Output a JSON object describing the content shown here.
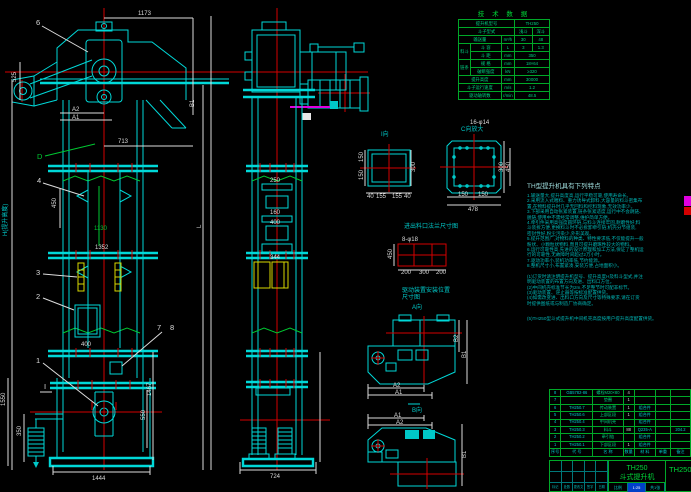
{
  "callouts": {
    "n1": "1",
    "n2": "2",
    "n3": "3",
    "n4": "4",
    "n6": "6",
    "n7": "7",
    "n8": "8"
  },
  "labels": {
    "h_axis": "H(提升高度)",
    "l_axis": "L",
    "d": "D",
    "sec": "I",
    "view_i": "I向",
    "view_c": "C向放大",
    "view_a": "A向",
    "view_b": "B向",
    "caption_flange": "进出料口法兰尺寸图",
    "drive1": "驱动装置安装位置",
    "drive2": "尺寸图"
  },
  "dims": {
    "head_width": "1173",
    "head_offset": "713",
    "head_height": "525",
    "a2": "A2",
    "a1": "A1",
    "head_b1": "B1",
    "section_green": "1130",
    "bucket_pitch": "450",
    "mid_width": "1352",
    "door_width": "400",
    "boot_h1": "1467",
    "boot_h2": "550",
    "boot_left": "1550",
    "spring_h": "350",
    "base_width": "1444",
    "front_width": "724",
    "f1": "250",
    "f2": "160",
    "f3": "400",
    "f4": "344",
    "fa_right": "300",
    "fa_left1": "150",
    "fa_left2": "150",
    "fa_b1": "40",
    "fa_b2": "155",
    "fa_b3": "155",
    "fa_b4": "40",
    "fb_note": "16-φ14",
    "fb_right1": "300",
    "fb_right2": "450",
    "fb_b1": "150",
    "fb_b2": "150",
    "fb_width": "478",
    "bolt_note": "8-φ18",
    "bolt_left": "450",
    "bolt_b1": "200",
    "bolt_b2": "300",
    "bolt_b3": "200",
    "va_a2": "A2",
    "va_a1": "A1",
    "va_b1": "B1",
    "va_b2": "B2",
    "vb_a1": "A1",
    "vb_a2": "A2",
    "vb_b1": "B1"
  },
  "tech": {
    "title": "技 术 数 据",
    "r1": {
      "label": "提升机型号",
      "value": "TH250"
    },
    "r2": {
      "label": "斗子型式",
      "v1": "浅斗",
      "v2": "深斗"
    },
    "r3": {
      "label": "输送量",
      "unit": "m³/h",
      "v1": "30",
      "v2": "48"
    },
    "r4": {
      "group": "料斗",
      "label": "斗 容",
      "unit": "L",
      "v1": "3",
      "v2": "1.3"
    },
    "r5": {
      "label": "斗 距",
      "unit": "mm",
      "value": "350"
    },
    "r6": {
      "group": "链条",
      "label": "规 格",
      "unit": "mm",
      "value": "18×64"
    },
    "r7": {
      "label": "破断强度",
      "unit": "kN",
      "value": "≥320"
    },
    "r8": {
      "label": "提升高度",
      "unit": "mm",
      "value": "30000"
    },
    "r9": {
      "label": "斗子运行速度",
      "unit": "m/s",
      "value": "1.2"
    },
    "r10": {
      "label": "驱动轴转数",
      "unit": "r/min",
      "value": "48.5"
    }
  },
  "features": {
    "heading": "TH型提升机具有下列特点",
    "lines": [
      "1.输送量大,提升高度高,运行平稳可靠,使用寿命长。",
      "2.采用流入式喂料、重力诱导式卸料,大容量的料斗密集布",
      "  置,在物料提升时几乎无回料和挖料现象,无效功率少。",
      "3.下部采用自动张紧装置,链条张紧适度,运行中不会跳链、",
      "  脱链,使用中不需经常调整,维护简单方便。",
      "4.牵引件采用高强度圆环链,与料斗连接牢固,耐磨性好;料",
      "  斗装拆方便,更换料斗时不必拆卸牵引链;机壳分节组装,",
      "  密封性好,粉尘污染少,外形美观。",
      "5.提升范围广,对物料的种类、特性要求低,不仅能提升一般",
      "  粉状、小颗粒状物料,而且可提升磨琢性较大的物料。",
      "6.运行可靠性高,先进的设计原理和加工方法,保证了整机运",
      "  行的可靠性,无故障时间超过2万小时。",
      "7.驱动功率小,装机功率低,节约能源。",
      "8.整机尺寸小,布置紧凑,安装方便,占地面积小。"
    ],
    "notes": [
      "(1)订货时请注明提升机型号、提升高度H及料斗型式,并注",
      "   明驱动装置的布置方向及进、出料口方位。",
      "(2)中间机壳标准节长为2m,不足整节时可配非标节。",
      "(3)驱动装置、逆止器等按标准配置供货。",
      "(4)如需改变进、出料口方向及尺寸等特殊要求,请在订货",
      "   时提供图纸或与制造厂协商确定。"
    ],
    "final": "(5)TH250型斗式提升机中间机壳高度按用户提升高度配置供货。"
  },
  "bom": {
    "headers": [
      "序号",
      "代 号",
      "名 称",
      "数量",
      "材 料",
      "单重",
      "备注"
    ],
    "rows": [
      [
        "8",
        "GB5782-86",
        "螺栓M20×80",
        "4",
        "",
        "",
        ""
      ],
      [
        "7",
        "",
        "垫圈",
        "1",
        "",
        "",
        ""
      ],
      [
        "6",
        "TH250.7",
        "传动装置",
        "1",
        "组合件",
        "",
        ""
      ],
      [
        "5",
        "TH250.6",
        "上部区段",
        "1",
        "组合件",
        "",
        ""
      ],
      [
        "4",
        "TH250.4",
        "中间机壳",
        "",
        "组合件",
        "",
        ""
      ],
      [
        "3",
        "TH250.3",
        "料斗",
        "88",
        "Q235-A",
        "",
        "204.2"
      ],
      [
        "2",
        "TH250.2",
        "牵引链",
        "",
        "组合件",
        "",
        ""
      ],
      [
        "1",
        "TH250.1",
        "下部区段",
        "1",
        "组合件",
        "",
        ""
      ]
    ]
  },
  "title_block": {
    "model": "TH250",
    "name": "斗式提升机",
    "drawing_no": "TH250",
    "scale_label": "比例",
    "scale_value": "1:25",
    "sheet": "共1张",
    "sig_row": [
      "标记",
      "处数",
      "更改文件号",
      "签字",
      "日期"
    ]
  }
}
